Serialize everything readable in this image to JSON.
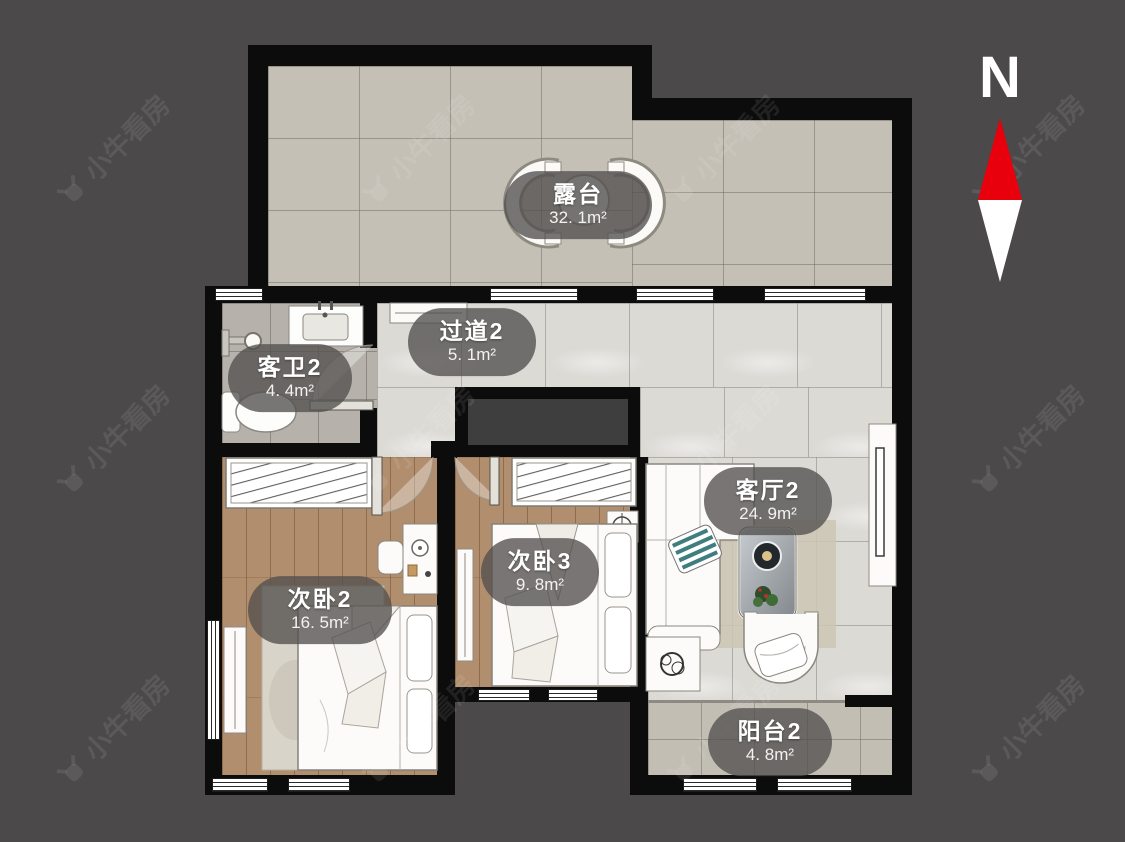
{
  "compass": {
    "label": "N"
  },
  "watermark": {
    "text": "小牛看房"
  },
  "rooms": [
    {
      "key": "terrace",
      "name": "露台",
      "area": "32. 1m²"
    },
    {
      "key": "hallway",
      "name": "过道2",
      "area": "5. 1m²"
    },
    {
      "key": "bathroom",
      "name": "客卫2",
      "area": "4. 4m²"
    },
    {
      "key": "living",
      "name": "客厅2",
      "area": "24. 9m²"
    },
    {
      "key": "bedroom2",
      "name": "次卧2",
      "area": "16. 5m²"
    },
    {
      "key": "bedroom3",
      "name": "次卧3",
      "area": "9. 8m²"
    },
    {
      "key": "balcony",
      "name": "阳台2",
      "area": "4. 8m²"
    }
  ],
  "colors": {
    "background": "#4b4949",
    "wall": "#0c0c0c",
    "compass_north_red": "#e8000d",
    "terrace_floor": "#c5c0b6",
    "marble_floor": "#dcdad5",
    "bath_floor": "#b6b2ab",
    "wood_floor": "#b18e6d",
    "balcony_floor": "#c3beb4",
    "label_pill": "rgba(82,80,78,0.78)"
  }
}
